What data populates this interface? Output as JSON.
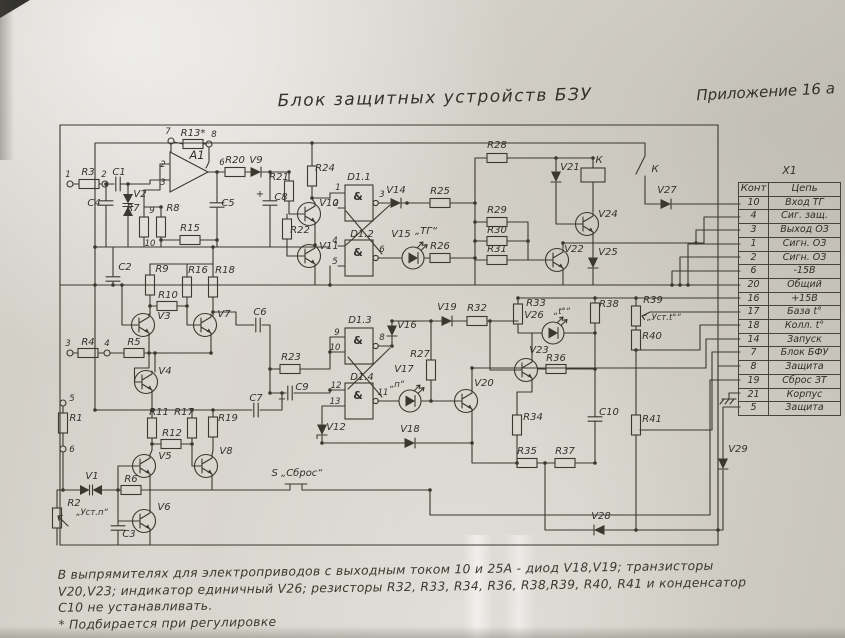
{
  "header": {
    "title": "Блок защитных устройств БЗУ",
    "appendix": "Приложение 16 а"
  },
  "connector": {
    "name": "X1",
    "columns": {
      "pin": "Конт",
      "circuit": "Цепь"
    },
    "rows": [
      {
        "pin": "10",
        "circuit": "Вход ТГ"
      },
      {
        "pin": "4",
        "circuit": "Сиг. защ."
      },
      {
        "pin": "3",
        "circuit": "Выход ОЗ"
      },
      {
        "pin": "1",
        "circuit": "Сигн. ОЗ"
      },
      {
        "pin": "2",
        "circuit": "Сигн. ОЗ"
      },
      {
        "pin": "6",
        "circuit": "-15В"
      },
      {
        "pin": "20",
        "circuit": "Общий"
      },
      {
        "pin": "16",
        "circuit": "+15В"
      },
      {
        "pin": "17",
        "circuit": "База t°"
      },
      {
        "pin": "18",
        "circuit": "Колл. t°"
      },
      {
        "pin": "14",
        "circuit": "Запуск"
      },
      {
        "pin": "7",
        "circuit": "Блок БФУ"
      },
      {
        "pin": "8",
        "circuit": "Защита"
      },
      {
        "pin": "19",
        "circuit": "Сброс ЗТ"
      },
      {
        "pin": "21",
        "circuit": "Корпус"
      },
      {
        "pin": "5",
        "circuit": "Защита"
      }
    ]
  },
  "notes": {
    "line1": "В выпрямителях  для  электроприводов  с  выходным  током  10 и 25А - диод V18,V19; транзисторы",
    "line2": "V20,V23;  индикатор  единичный  V26;  резисторы  R32, R33, R34, R36, R38,R39, R40, R41  и  конденсатор",
    "line3": "С10 не устанавливать.",
    "line4": "* Подбирается  при  регулировке"
  },
  "pins": {
    "n1": "1",
    "n2": "2",
    "n3": "3",
    "n4": "4",
    "n5": "5",
    "n6": "6",
    "n7": "7",
    "n8": "8",
    "n9": "9",
    "n10": "10",
    "n11": "11",
    "n12": "12",
    "n13": "13"
  },
  "labels": {
    "r1": "R1",
    "r2": "R2",
    "r2_note": "„Уст.п“",
    "r3": "R3",
    "r4": "R4",
    "r5": "R5",
    "r6": "R6",
    "r7": "R7",
    "r8": "R8",
    "r9": "R9",
    "r10": "R10",
    "r11": "R11",
    "r12": "R12",
    "r13": "R13*",
    "r15": "R15",
    "r16": "R16",
    "r17": "R17",
    "r18": "R18",
    "r19": "R19",
    "r20": "R20",
    "r21": "R21",
    "r22": "R22",
    "r23": "R23",
    "r24": "R24",
    "r25": "R25",
    "r26": "R26",
    "r27": "R27",
    "r28": "R28",
    "r29": "R29",
    "r30": "R30",
    "r31": "R31",
    "r32": "R32",
    "r33": "R33",
    "r34": "R34",
    "r35": "R35",
    "r36": "R36",
    "r37": "R37",
    "r38": "R38",
    "r39": "R39",
    "r39_note": "„Уст.t°“",
    "r40": "R40",
    "r41": "R41",
    "c1": "C1",
    "c2": "C2",
    "c3": "C3",
    "c4": "C4",
    "c5": "C5",
    "c6": "C6",
    "c7": "C7",
    "c8": "C8",
    "c9": "C9",
    "c10": "C10",
    "plus": "+",
    "v1": "V1",
    "v2": "V2",
    "v3": "V3",
    "v4": "V4",
    "v5": "V5",
    "v6": "V6",
    "v7": "V7",
    "v8": "V8",
    "v9": "V9",
    "v10": "V10",
    "v11": "V11",
    "v12": "V12",
    "v14": "V14",
    "v15": "V15",
    "v15_note": "„ТГ“",
    "v16": "V16",
    "v17": "V17",
    "v17_note": "„п“",
    "v18": "V18",
    "v19": "V19",
    "v20": "V20",
    "v21": "V21",
    "v22": "V22",
    "v23": "V23",
    "v24": "V24",
    "v25": "V25",
    "v26": "V26",
    "v26_note": "„t°“",
    "v27": "V27",
    "v28": "V28",
    "v29": "V29",
    "a1": "A1",
    "d11": "D1.1",
    "d12": "D1.2",
    "d13": "D1.3",
    "d14": "D1.4",
    "amp": "&",
    "k_coil": "К",
    "k_contact": "К",
    "s_reset": "S „Сброс“",
    "x1": "X1"
  }
}
